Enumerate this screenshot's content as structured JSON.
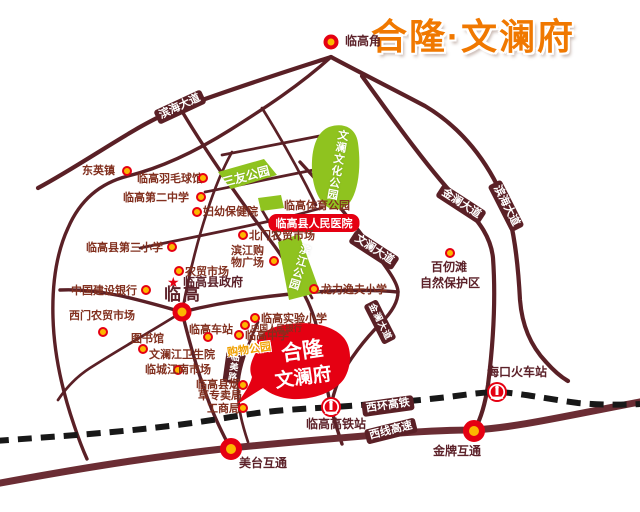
{
  "title": "合隆·文澜府",
  "project_bubble": {
    "line1": "合隆",
    "line2": "文澜府"
  },
  "landmark_cape": "临高角",
  "city": {
    "name": "临高",
    "government": "临高县政府"
  },
  "hospital_badge": "临高县人民医院",
  "nature_reserve": {
    "line1": "百仞滩",
    "line2": "自然保护区"
  },
  "road_labels": {
    "binhai_nw": "滨海大道",
    "binhai_e": "滨海大道",
    "jinlan_ne": "金澜大道",
    "jinlan_s": "金澜大道",
    "wenlan": "文澜大道",
    "linmei": "临美路",
    "rail_line": "西环高铁",
    "expressway": "西线高速"
  },
  "parks": {
    "sanyou": "三友公园",
    "wenlan_culture": "文澜文化公园",
    "sports": "临高体育公园",
    "binjiang": "滨江公园"
  },
  "stations": {
    "lingao_hsr": "临高高铁站",
    "haikou_rail": "海口火车站",
    "lingao_bus": "临高车站"
  },
  "interchanges": {
    "meitai": "美台互通",
    "jinpai": "金牌互通"
  },
  "pois": {
    "dongyingzhen": "东英镇",
    "badminton": "临高羽毛球馆",
    "no2_middle": "临高第二中学",
    "no3_primary": "临高县第三小学",
    "ccb": "中国建设银行",
    "ximen_market": "西门农贸市场",
    "library": "图书馆",
    "wenlanjiang_clinic": "文澜江卫生院",
    "jiangnan_market": "临城江南市场",
    "tobacco_line1": "临高县烟",
    "tobacco_line2": "草专卖局",
    "gongshangju": "工商局",
    "fuyou_hospital": "妇幼保健院",
    "beimen_market": "北门农贸市场",
    "binjiang_mall_line1": "滨江购",
    "binjiang_mall_line2": "物广场",
    "nongmao_market": "农贸市场",
    "experimental_primary": "临高实验小学",
    "pboc": "中国人民银行",
    "lingao_middle": "临高中学",
    "shopping_park": "购物公园",
    "longli_primary": "龙力逸夫小学"
  },
  "icons": {
    "poi_marker": "bullseye-dot",
    "interchange_marker": "bullseye-ring-large",
    "government_marker": "red-star",
    "train_station": "china-railway-roundel"
  },
  "colors": {
    "road": "#5a2026",
    "highway": "#6b2d34",
    "railway": "#181818",
    "park_green": "#8fc31f",
    "accent_red": "#e50012",
    "marker_yellow": "#fcb700",
    "title_orange": "#f07800",
    "poi_text": "#82301f"
  }
}
